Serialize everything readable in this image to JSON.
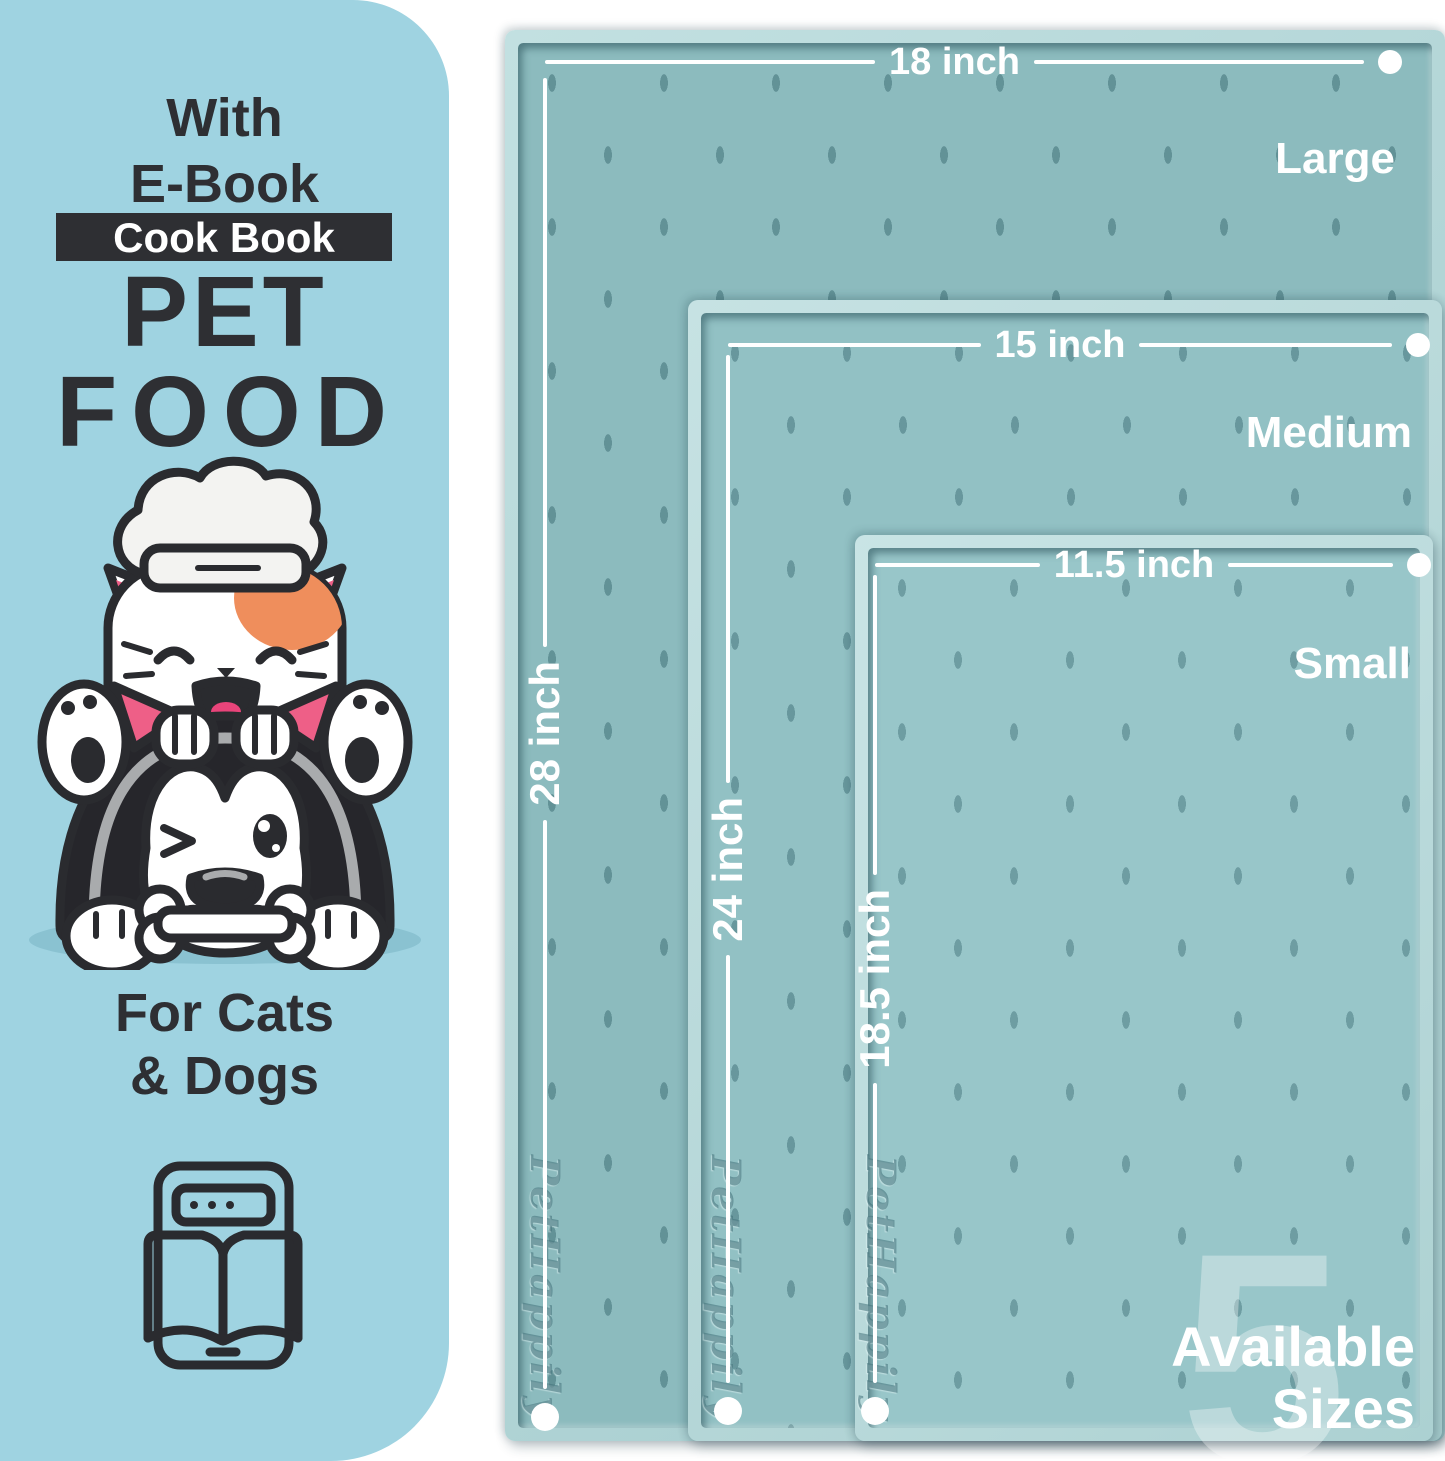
{
  "panel": {
    "headline_line1": "With",
    "headline_line2": "E-Book",
    "badge_label": "Cook Book",
    "title_line1": "PET",
    "title_line2": "FOOD",
    "audience_line1": "For Cats",
    "audience_line2": "& Dogs"
  },
  "mats": [
    {
      "size_label": "Large",
      "width_label": "18 inch",
      "height_label": "28 inch",
      "brand_embossed": "PetHappily"
    },
    {
      "size_label": "Medium",
      "width_label": "15 inch",
      "height_label": "24 inch",
      "brand_embossed": "PetHappily"
    },
    {
      "size_label": "Small",
      "width_label": "11.5 inch",
      "height_label": "18.5 inch",
      "brand_embossed": "PetHappily"
    }
  ],
  "availability": {
    "count": "5",
    "line1": "Available",
    "line2": "Sizes"
  },
  "icons": {
    "illustration": "chef-cat-and-dog-with-bone",
    "ebook": "tablet-with-open-book"
  },
  "colors": {
    "panel_blue": "#9fd3e1",
    "ink_dark": "#2e2f33",
    "mat_teal": "#8cbbbe",
    "mat_rim": "#bfe0e1",
    "dimension_white": "#ffffff",
    "tongue_pink": "#e9447a",
    "ear_pink": "#ee5f87",
    "patch_orange": "#ef8e5c"
  }
}
